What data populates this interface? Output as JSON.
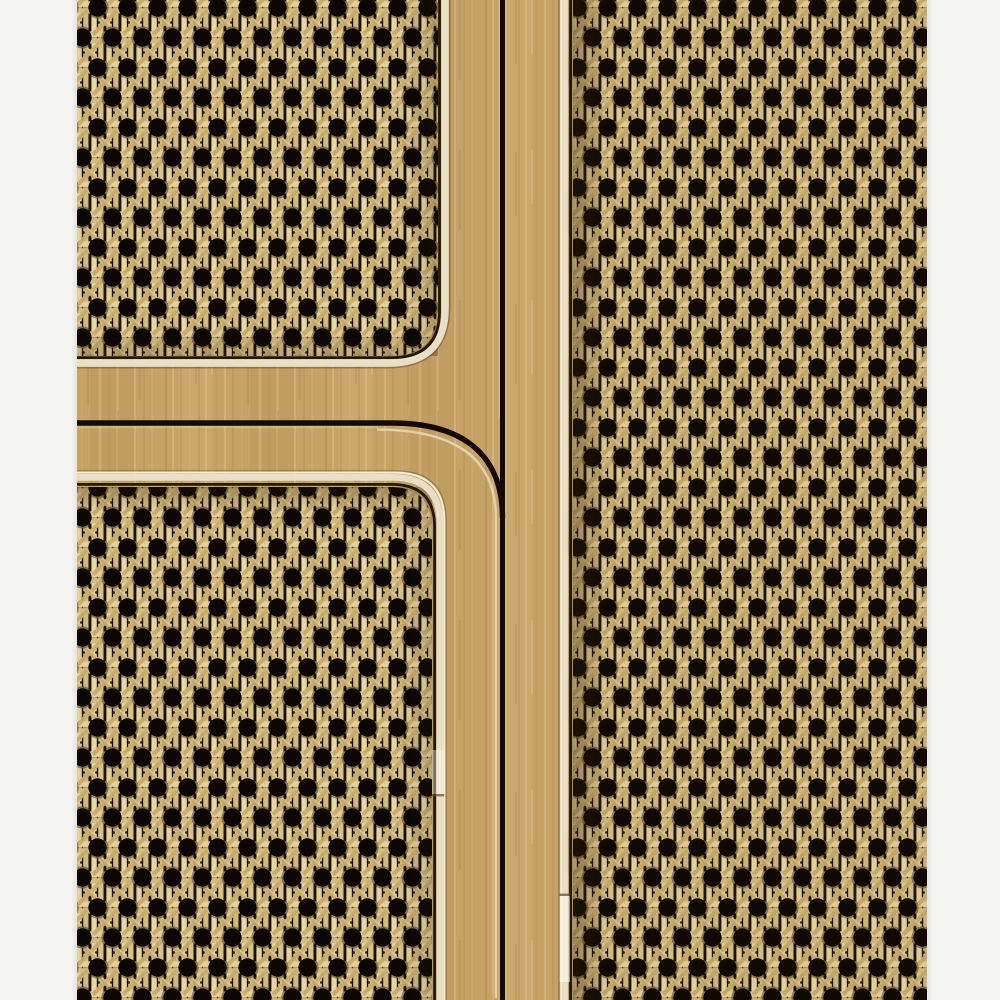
{
  "image": {
    "type": "photograph",
    "caption": "Close-up of a light oak cabinet front with Vienna cane webbing panels: two stacked cane doors on the left separated by a curved routed groove, and one tall cane door on the right, each panel edged with cream piping trim, on a plain white background"
  },
  "palette": {
    "background": "#f5f5f3",
    "wood_base": "#c6a266",
    "wood_streak_dark": "#a07c46",
    "wood_streak_light": "#e2c78f",
    "cane_strand_light": "#e9d6a0",
    "cane_strand_mid": "#d5bc81",
    "cane_diagonal": "#c8ac6e",
    "cane_hole": "#0b0603",
    "cane_gap_dark": "#191106",
    "trim_cream": "#e9dfc5",
    "trim_bright": "#f7f2e2",
    "trim_shadow": "#8d7850",
    "seam_dark": "#140c04",
    "panel_gap_dark": "#241808"
  },
  "layout": {
    "canvas": {
      "width": 1000,
      "height": 1000
    },
    "white_margin_left": {
      "x": 0,
      "width": 77
    },
    "white_margin_right": {
      "x": 927,
      "width": 73
    },
    "vertical_seam_x": 502,
    "horizontal_groove_y": 423,
    "groove_corner_radius": 78,
    "rail_band": {
      "top": 356,
      "bottom": 487
    }
  },
  "cane_pattern": {
    "hole_pitch_x": 30,
    "row_spacing": 30,
    "row_stagger": 15,
    "hole_diameter": 18.5,
    "strand_width": 5.4
  },
  "regions": {
    "cabinet": {
      "label": "Oak cabinet front with cane webbing panels"
    },
    "door_top_left": {
      "label": "Upper left cane webbing panel with rounded bottom-right corner"
    },
    "door_bottom_left": {
      "label": "Lower left cane webbing panel with rounded top-right corner"
    },
    "door_right": {
      "label": "Tall right cane webbing door panel"
    },
    "wood_frame": {
      "label": "Light oak frame rails and stiles with vertical grain"
    },
    "vertical_seam": {
      "label": "Dark vertical gap between left doors and right door"
    },
    "curved_groove": {
      "label": "Horizontal door gap curving down into the vertical seam"
    },
    "trim_top_left": {
      "label": "Cream piping trim around upper left panel"
    },
    "trim_bottom_left": {
      "label": "Cream piping trim around lower left panel"
    },
    "trim_right": {
      "label": "Cream piping trim along right panel edge"
    },
    "trim_joint_left": {
      "label": "Butt joint in left piping trim"
    },
    "trim_joint_right": {
      "label": "Butt joint in right piping trim"
    },
    "background_left": {
      "label": "White background strip on the left"
    },
    "background_right": {
      "label": "White background strip on the right"
    }
  }
}
